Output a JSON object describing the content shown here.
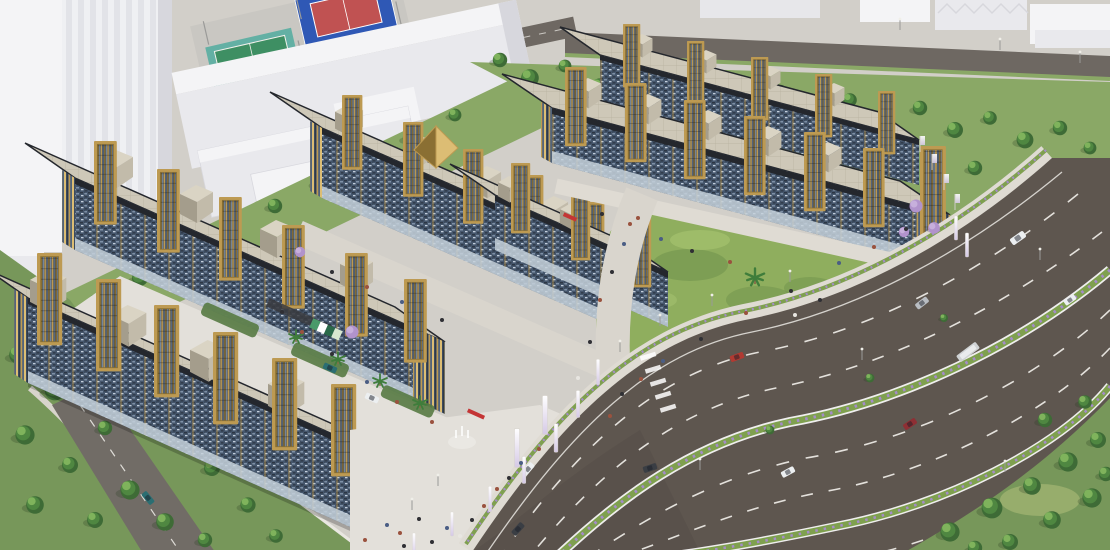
{
  "scene": {
    "type": "aerial-architectural-render",
    "time_of_day": "day",
    "labels": {
      "root": "Aerial 3D rendering of a mixed-use retail development beside a highway",
      "complex": "Retail complex rows with blue mosaic facades and gold tower frames",
      "context_district": "Surrounding white city blocks, terraced houses and industrial sheds",
      "sports_courts": "Tennis court and basketball court",
      "highway": "Curving multi-lane divided highway with flowering medians",
      "lawn": "Central landscaped lawn with grass mounds and palm",
      "courtyard": "Inner courtyard with planters, palms and parked cars",
      "boulevard": "Pedestrian boulevard through the complex",
      "entrance_plaza": "Main entrance plaza with white pylons and fountain",
      "gold_pavilion": "Gold pyramidal pavilion roof at the gateway",
      "perimeter_greenery": "Perimeter tree belts and landscaping",
      "side_road": "Small side street with pickup truck",
      "back_road": "Rear service road with street lights",
      "pedestrians": "Pedestrians on walkways and sidewalks"
    },
    "inventory": {
      "building_rows": 6,
      "gold_tower_frames": 32,
      "rooftop_cubes": 21,
      "sports_courts": [
        "tennis-green",
        "basketball-blue-red"
      ],
      "highway_vehicles": [
        {
          "type": "minibus",
          "color": "white"
        },
        {
          "type": "sedan",
          "color": "white"
        },
        {
          "type": "sedan",
          "color": "silver"
        },
        {
          "type": "suv",
          "color": "red"
        },
        {
          "type": "bus",
          "color": "grey"
        },
        {
          "type": "suv",
          "color": "dark-red"
        },
        {
          "type": "sedan",
          "color": "white"
        },
        {
          "type": "sedan",
          "color": "dark-grey"
        },
        {
          "type": "sedan",
          "color": "white"
        },
        {
          "type": "sedan",
          "color": "dark-grey"
        }
      ],
      "courtyard_vehicles": [
        {
          "type": "pickup",
          "color": "teal-blue"
        },
        {
          "type": "sedan",
          "color": "white"
        },
        {
          "type": "suv",
          "color": "red"
        },
        {
          "type": "sedan",
          "color": "blue"
        },
        {
          "type": "van",
          "color": "dark"
        }
      ],
      "side_road_vehicles": [
        {
          "type": "pickup",
          "color": "teal"
        }
      ]
    }
  },
  "palette": {
    "ground": "#c9cdc2",
    "districtPave": "#d2cfc9",
    "grassLight": "#a9bd84",
    "grassMid": "#8aa866",
    "grassDark": "#77975a",
    "treeDark": "#3e6b36",
    "treeMid": "#4f8741",
    "treeLight": "#7fb35c",
    "lawn": "#8fae5e",
    "lawnLight": "#a8c472",
    "lawnDark": "#70924c",
    "whiteTop": "#f4f4f6",
    "whiteMid": "#e9e9ed",
    "whiteShade": "#d7d7dd",
    "courtPad": "#c9c7c2",
    "courtGreenOuter": "#63b0a4",
    "courtGreen": "#3e8f63",
    "courtBlue": "#2f58b5",
    "courtRed": "#c05252",
    "asphalt": "#5e564f",
    "asphaltDark": "#4c453f",
    "roadBack": "#6e6862",
    "roadLine": "#f3f1ec",
    "medianGreen": "#7fa04f",
    "flowerPurple": "#a48cc8",
    "sidewalk": "#dfdbd3",
    "plaza": "#e3e0da",
    "boulevard": "#d9d5cd",
    "wallLight": "#e9e7e1",
    "facadeBase": "#45566c",
    "facadeDark": "#2c3644",
    "facadeLight": "#7e90a6",
    "facadeFleck": "#c3cedb",
    "parapet": "#24272d",
    "glassStrip": "#c6d1da",
    "gold": "#bd9a52",
    "goldDark": "#8a6f33",
    "goldLight": "#dcbd74",
    "towerDark": "#2e3948",
    "towerSteel": "#5b6d85",
    "roofBeige": "#cec8b8",
    "roofLine": "#b7b09f",
    "cubeTop": "#dad4c4",
    "cubeFront": "#c2bbaa",
    "cubeSide": "#a49d8c",
    "purpleTree": "#b193cc",
    "purpleTreeLight": "#c7afdc",
    "palmGreen": "#3f7d3b",
    "trunk": "#8a6a48",
    "carRed": "#b03a32",
    "carDarkRed": "#8e2f34",
    "carBlue": "#2f62b5",
    "carTeal": "#2b6e72",
    "carWhite": "#eceff1",
    "carSilver": "#b9bdc2",
    "carDark": "#3a3e44",
    "busGrey": "#cfd2d4",
    "personDark": "#2f2f34",
    "personWarm": "#9a523e",
    "personLight": "#e8e6e1",
    "personBlue": "#4a5d84",
    "pylon": "#f4f2f0",
    "redLed": "#c43535",
    "planter": "#567a43",
    "pergola": "#3a3b3f"
  }
}
